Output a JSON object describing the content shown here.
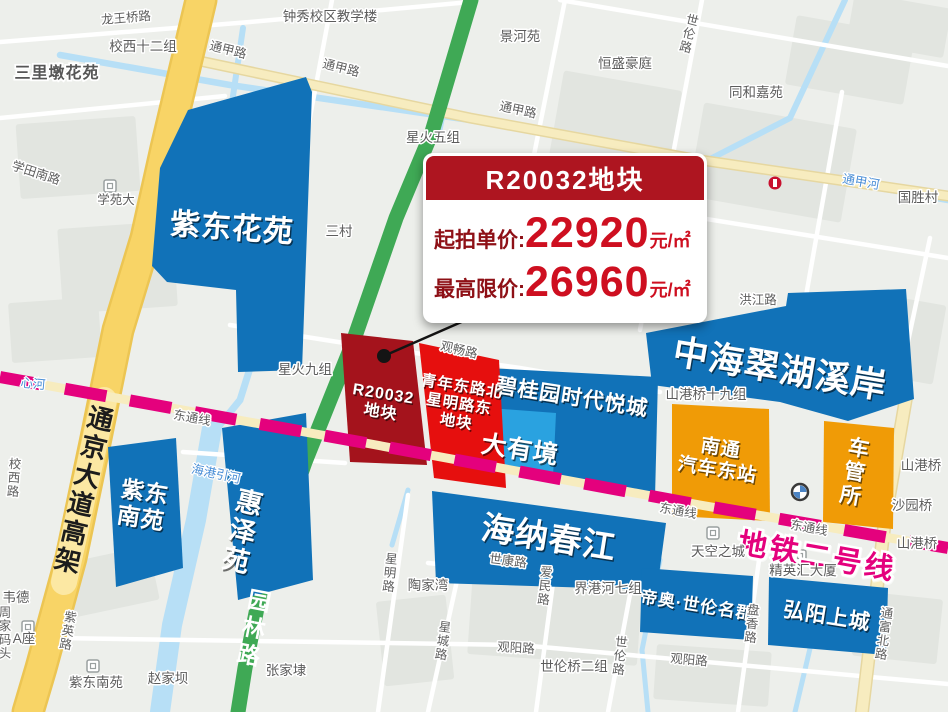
{
  "callout": {
    "title": "R20032地块",
    "rows": [
      {
        "label": "起拍单价:",
        "value": "22920",
        "unit": "元/㎡"
      },
      {
        "label": "最高限价:",
        "value": "26960",
        "unit": "元/㎡"
      }
    ]
  },
  "colors": {
    "parcel_blue": "#1172b8",
    "parcel_lightblue": "#2aa2e0",
    "parcel_orange": "#f09b06",
    "parcel_darkred": "#a4131c",
    "parcel_red": "#e60f0e",
    "metro_pink": "#e4017d",
    "highway_yellow": "#f8d466",
    "green_road": "#3fa955",
    "callout_header": "#ae1520",
    "price_red": "#ce0f20"
  },
  "map": {
    "labels": [
      {
        "t": "紫东花苑",
        "x": 232,
        "y": 228,
        "rot": 4,
        "size": 30,
        "cls": "parcel",
        "n": "parcel-label-zidonghuayuan"
      },
      {
        "lines": [
          "紫东",
          "南苑"
        ],
        "x": 143,
        "y": 505,
        "rot": 9,
        "size": 23,
        "cls": "parcel",
        "n": "parcel-label-zidongnanyuan"
      },
      {
        "t": "惠泽苑",
        "x": 243,
        "y": 532,
        "rot": 13,
        "vert": true,
        "size": 27,
        "cls": "parcel",
        "n": "parcel-label-huizeyuan"
      },
      {
        "t": "海纳春江",
        "x": 549,
        "y": 537,
        "rot": 9,
        "size": 33,
        "cls": "parcel",
        "n": "parcel-label-hainachunjiang"
      },
      {
        "t": "碧桂园时代悦城",
        "x": 572,
        "y": 397,
        "rot": 9,
        "size": 21,
        "cls": "parcel",
        "n": "parcel-label-biguiyuan"
      },
      {
        "t": "大有境",
        "x": 520,
        "y": 450,
        "rot": 9,
        "size": 25,
        "cls": "parcel",
        "n": "parcel-label-dayoujing"
      },
      {
        "t": "中海翠湖溪岸",
        "x": 780,
        "y": 369,
        "rot": 9.5,
        "size": 35,
        "cls": "parcel",
        "n": "parcel-label-zhonghai"
      },
      {
        "lines": [
          "南通",
          "汽车东站"
        ],
        "x": 719,
        "y": 459,
        "rot": 9,
        "size": 19,
        "cls": "parcel",
        "n": "parcel-label-qichedongzhan"
      },
      {
        "t": "车管所",
        "x": 855,
        "y": 472,
        "rot": 10,
        "vert": true,
        "size": 21,
        "ls": 1.15,
        "cls": "parcel",
        "n": "parcel-label-cheguansuo"
      },
      {
        "t": "帝奥·世伦名郡",
        "x": 697,
        "y": 605,
        "rot": 9,
        "size": 17,
        "cls": "parcel",
        "n": "parcel-label-diao"
      },
      {
        "t": "弘阳上城",
        "x": 827,
        "y": 616,
        "rot": 9,
        "size": 21,
        "cls": "parcel",
        "n": "parcel-label-hongyang"
      },
      {
        "lines": [
          "R20032",
          "地块"
        ],
        "x": 382,
        "y": 403,
        "rot": 9,
        "size": 16,
        "cls": "parcel",
        "n": "parcel-label-r20032"
      },
      {
        "lines": [
          "青年东路北",
          "星明路东",
          "地块"
        ],
        "x": 459,
        "y": 404,
        "rot": 9,
        "size": 15.5,
        "cls": "parcel",
        "n": "parcel-label-qingnian"
      },
      {
        "t": "通京大道高架",
        "x": 84,
        "y": 490,
        "rot": 13,
        "vert": true,
        "size": 26,
        "ls": 1.12,
        "cls": "hwy",
        "n": "road-label-tongjing"
      },
      {
        "t": "园林路",
        "x": 254,
        "y": 628,
        "rot": 11,
        "vert": true,
        "size": 23,
        "ls": 1.2,
        "cls": "greenroad",
        "n": "road-label-yuanlin"
      },
      {
        "t": "地铁二号线",
        "x": 817,
        "y": 557,
        "rot": 10,
        "cls": "metro",
        "n": "metro-line-label"
      },
      {
        "t": "三里墩花苑",
        "x": 57,
        "y": 73,
        "cls": "area-lg"
      },
      {
        "t": "校西十二组",
        "x": 143,
        "y": 46,
        "cls": "area"
      },
      {
        "t": "钟秀校区教学楼",
        "x": 330,
        "y": 16,
        "cls": "area"
      },
      {
        "t": "景河苑",
        "x": 520,
        "y": 36,
        "cls": "area"
      },
      {
        "t": "恒盛豪庭",
        "x": 625,
        "y": 63,
        "cls": "area"
      },
      {
        "t": "同和嘉苑",
        "x": 756,
        "y": 92,
        "cls": "area"
      },
      {
        "t": "国胜村",
        "x": 918,
        "y": 197,
        "cls": "area"
      },
      {
        "t": "星火五组",
        "x": 433,
        "y": 137,
        "cls": "area"
      },
      {
        "t": "三村",
        "x": 339,
        "y": 231,
        "cls": "area"
      },
      {
        "t": "星火九组",
        "x": 305,
        "y": 369,
        "cls": "area"
      },
      {
        "t": "山港桥十九组",
        "x": 706,
        "y": 394,
        "size": 11.5,
        "cls": "area"
      },
      {
        "t": "洪江路",
        "x": 758,
        "y": 300,
        "cls": "road"
      },
      {
        "t": "陶家湾",
        "x": 428,
        "y": 585,
        "cls": "area"
      },
      {
        "t": "界港河七组",
        "x": 608,
        "y": 588,
        "cls": "area"
      },
      {
        "t": "世伦桥二组",
        "x": 574,
        "y": 666,
        "cls": "area"
      },
      {
        "t": "天空之城",
        "x": 718,
        "y": 551,
        "cls": "area"
      },
      {
        "t": "精英汇大厦",
        "x": 803,
        "y": 570,
        "cls": "area"
      },
      {
        "t": "赵家坝",
        "x": 168,
        "y": 678,
        "cls": "area"
      },
      {
        "t": "张家埭",
        "x": 286,
        "y": 670,
        "cls": "area"
      },
      {
        "t": "紫东南苑",
        "x": 96,
        "y": 682,
        "cls": "area"
      },
      {
        "t": "韦德",
        "x": 16,
        "y": 597,
        "cls": "area"
      },
      {
        "t": "A座",
        "x": 24,
        "y": 638,
        "cls": "area"
      },
      {
        "t": "山港桥",
        "x": 921,
        "y": 465,
        "cls": "area"
      },
      {
        "t": "沙园桥",
        "x": 912,
        "y": 505,
        "cls": "area"
      },
      {
        "t": "山港桥",
        "x": 917,
        "y": 543,
        "cls": "area"
      },
      {
        "t": "龙王桥路",
        "x": 126,
        "y": 18,
        "rot": -5,
        "cls": "road"
      },
      {
        "t": "通甲路",
        "x": 228,
        "y": 50,
        "rot": 14,
        "cls": "road"
      },
      {
        "t": "通甲路",
        "x": 341,
        "y": 68,
        "rot": 14,
        "cls": "road"
      },
      {
        "t": "通甲路",
        "x": 518,
        "y": 110,
        "rot": 12,
        "cls": "road"
      },
      {
        "t": "学田南路",
        "x": 36,
        "y": 173,
        "rot": 18,
        "cls": "road"
      },
      {
        "t": "学苑大",
        "x": 116,
        "y": 200,
        "cls": "road"
      },
      {
        "t": "观畅路",
        "x": 459,
        "y": 350,
        "rot": 13,
        "cls": "road"
      },
      {
        "t": "东通线",
        "x": 192,
        "y": 418,
        "rot": 10,
        "cls": "road"
      },
      {
        "t": "东通线",
        "x": 678,
        "y": 511,
        "rot": 10,
        "cls": "road"
      },
      {
        "t": "东通线",
        "x": 809,
        "y": 528,
        "rot": 10,
        "cls": "road"
      },
      {
        "t": "世康路",
        "x": 508,
        "y": 561,
        "rot": 7,
        "cls": "road"
      },
      {
        "t": "观阳路",
        "x": 516,
        "y": 648,
        "rot": 3,
        "cls": "road"
      },
      {
        "t": "观阳路",
        "x": 689,
        "y": 660,
        "rot": 5,
        "cls": "road"
      },
      {
        "t": "世伦路",
        "x": 689,
        "y": 34,
        "rot": 14,
        "vert": true,
        "cls": "road"
      },
      {
        "t": "校西路",
        "x": 14,
        "y": 478,
        "rot": 4,
        "vert": true,
        "cls": "road"
      },
      {
        "t": "星明路",
        "x": 390,
        "y": 573,
        "rot": 6,
        "vert": true,
        "cls": "road"
      },
      {
        "t": "星城路",
        "x": 443,
        "y": 641,
        "rot": 8,
        "vert": true,
        "cls": "road"
      },
      {
        "t": "爱民路",
        "x": 545,
        "y": 586,
        "rot": 6,
        "vert": true,
        "cls": "road"
      },
      {
        "t": "世伦路",
        "x": 620,
        "y": 656,
        "rot": 6,
        "vert": true,
        "cls": "road"
      },
      {
        "t": "盘香路",
        "x": 752,
        "y": 624,
        "rot": 6,
        "vert": true,
        "cls": "road"
      },
      {
        "t": "通富北路",
        "x": 884,
        "y": 634,
        "rot": 8,
        "vert": true,
        "cls": "road"
      },
      {
        "t": "紫英路",
        "x": 68,
        "y": 631,
        "rot": 10,
        "vert": true,
        "cls": "road"
      },
      {
        "t": "周家码头",
        "x": 5,
        "y": 633,
        "vert": true,
        "cls": "road"
      },
      {
        "t": "心河",
        "x": 33,
        "y": 384,
        "rot": 5,
        "cls": "river"
      },
      {
        "t": "通甲河",
        "x": 861,
        "y": 182,
        "rot": 10,
        "cls": "river"
      },
      {
        "t": "海港引河",
        "x": 216,
        "y": 474,
        "rot": 12,
        "cls": "river"
      }
    ]
  }
}
